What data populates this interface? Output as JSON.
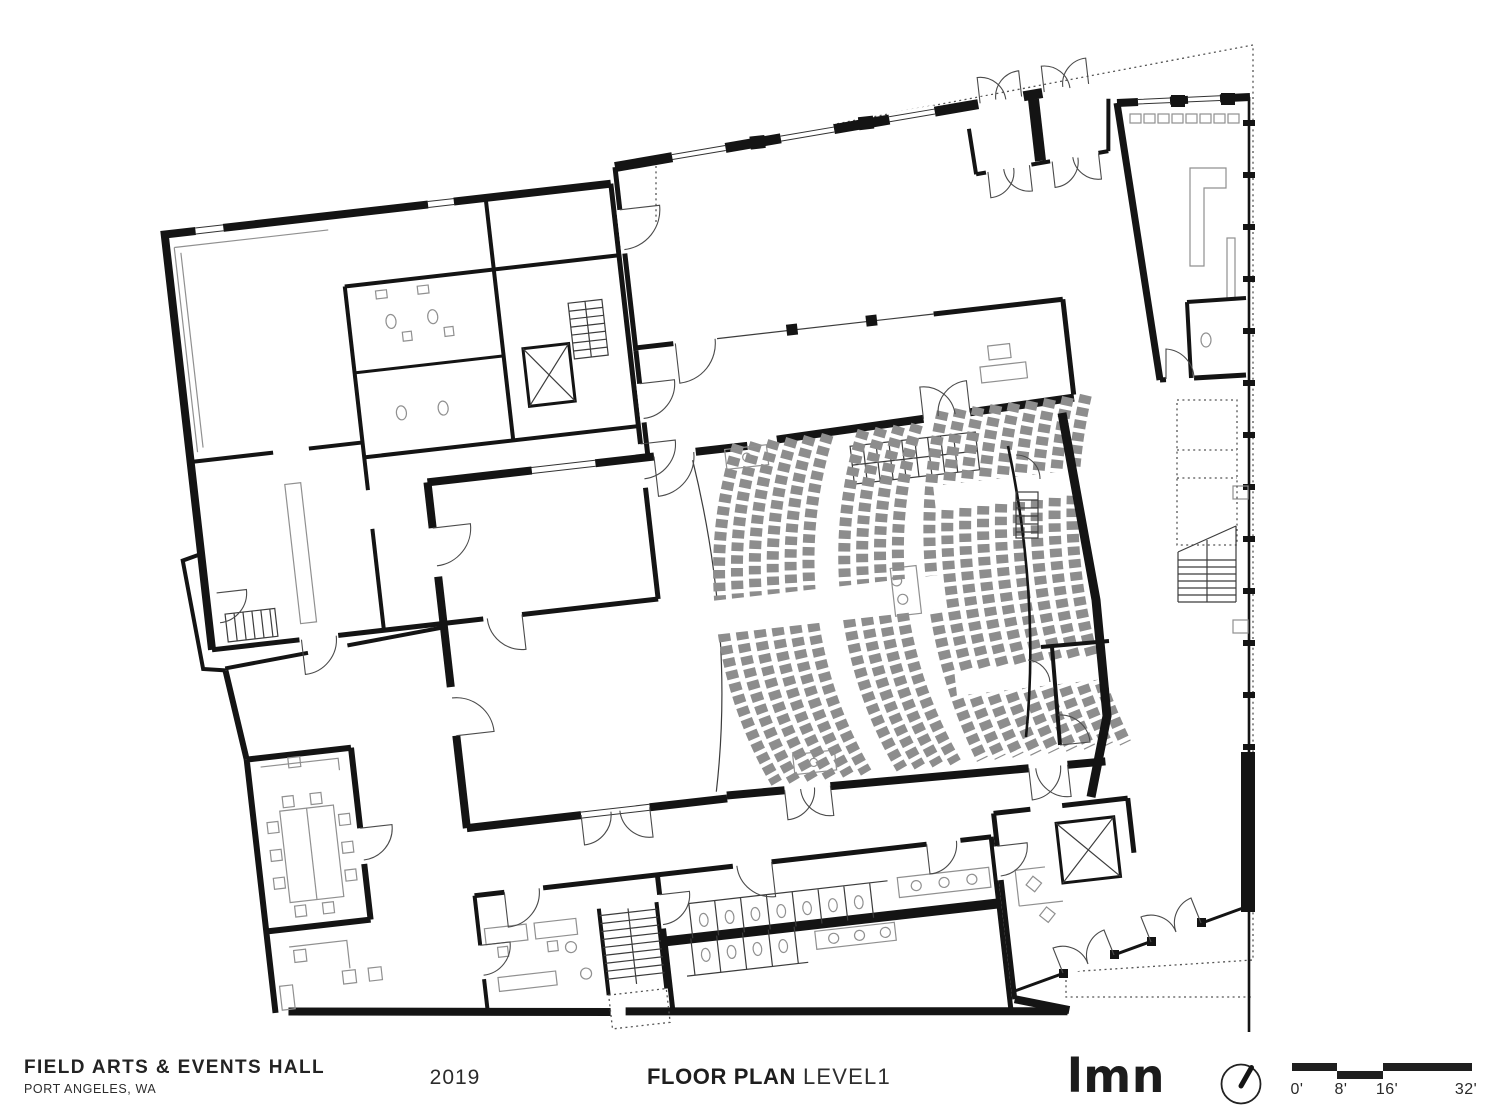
{
  "colors": {
    "bg": "#ffffff",
    "ink": "#1f1f1f",
    "wall": "#141414",
    "seat": "#8d8d8d",
    "furn": "#909090",
    "door": "#4a4a4a",
    "dotted": "#555555"
  },
  "title_block": {
    "project_title": "FIELD ARTS & EVENTS HALL",
    "project_location": "PORT ANGELES, WA",
    "year": "2019",
    "sheet_title": "FLOOR PLAN",
    "sheet_subtitle": "LEVEL1",
    "logo": "LMN"
  },
  "scale_bar": {
    "labels": [
      "0'",
      "8'",
      "16'",
      "32'"
    ]
  }
}
